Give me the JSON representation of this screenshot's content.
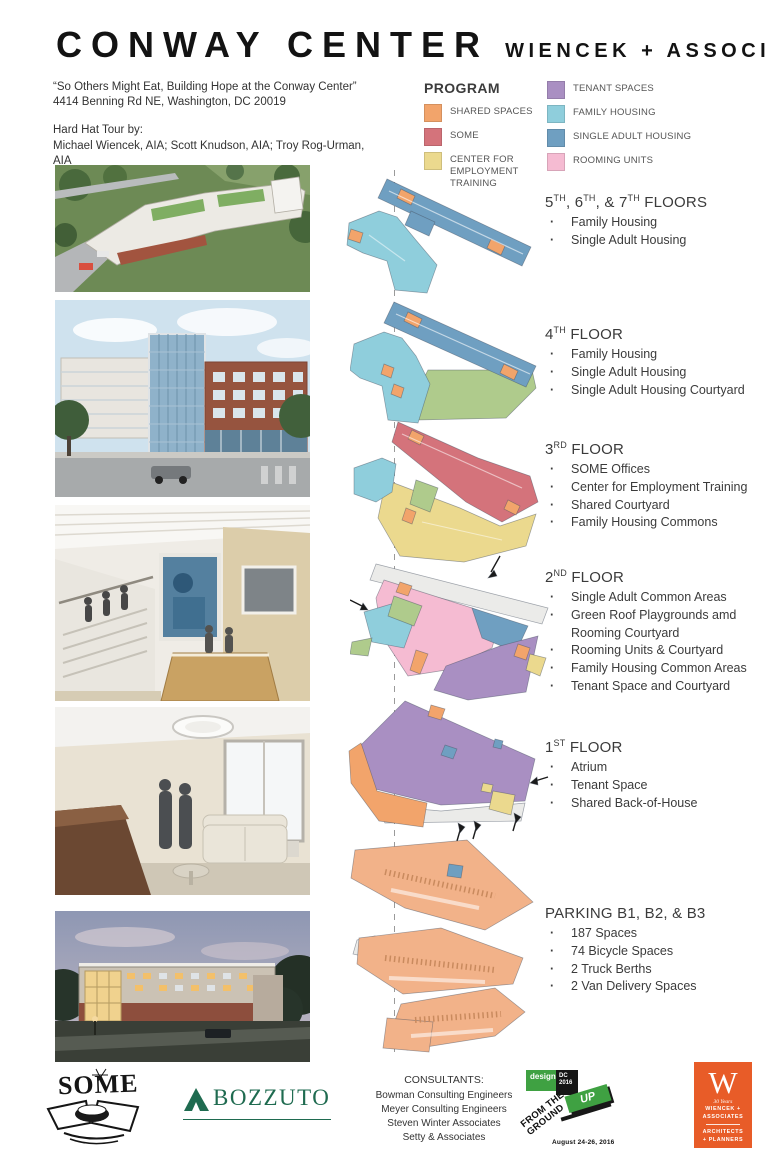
{
  "header": {
    "title": "CONWAY CENTER",
    "firm": "WIENCEK + ASSOCIATES"
  },
  "intro": {
    "quote": "“So Others Might Eat, Building Hope at the Conway Center”",
    "address": "4414 Benning Rd NE, Washington, DC 20019",
    "tour_label": "Hard Hat Tour by:",
    "tour_names": "Michael Wiencek, AIA; Scott Knudson, AIA; Troy Rog-Urman, AIA"
  },
  "colors": {
    "shared": "#F2A46B",
    "some": "#D4737B",
    "cet": "#EBD98E",
    "tenant": "#A98FC2",
    "family": "#8FCEDC",
    "single": "#6F9FC1",
    "rooming": "#F5BBD2",
    "parking": "#F2B289",
    "courtyard": "#AFCB8C",
    "grey": "#EBEBE9",
    "badge": "#E85C28",
    "bozzuto": "#1F6B50",
    "event_green": "#3FA142"
  },
  "legend": {
    "title": "PROGRAM",
    "items": [
      {
        "key": "shared",
        "label": "SHARED SPACES"
      },
      {
        "key": "some",
        "label": "SOME"
      },
      {
        "key": "cet",
        "label": "CENTER FOR EMPLOYMENT TRAINING"
      },
      {
        "key": "tenant",
        "label": "TENANT SPACES"
      },
      {
        "key": "family",
        "label": "FAMILY HOUSING"
      },
      {
        "key": "single",
        "label": "SINGLE ADULT HOUSING"
      },
      {
        "key": "rooming",
        "label": "ROOMING UNITS"
      }
    ]
  },
  "floors": [
    {
      "title_parts": [
        {
          "text": "5"
        },
        {
          "text": "TH",
          "sup": true
        },
        {
          "text": ", 6"
        },
        {
          "text": "TH",
          "sup": true
        },
        {
          "text": ", &  7"
        },
        {
          "text": "TH",
          "sup": true
        },
        {
          "text": " FLOORS"
        }
      ],
      "bullets": [
        "Family Housing",
        "Single Adult Housing"
      ]
    },
    {
      "title_parts": [
        {
          "text": "4"
        },
        {
          "text": "TH",
          "sup": true
        },
        {
          "text": " FLOOR"
        }
      ],
      "bullets": [
        "Family Housing",
        "Single Adult Housing",
        "Single Adult Housing Courtyard"
      ]
    },
    {
      "title_parts": [
        {
          "text": "3"
        },
        {
          "text": "RD",
          "sup": true
        },
        {
          "text": " FLOOR"
        }
      ],
      "bullets": [
        "SOME Offices",
        "Center for Employment Training",
        "Shared Courtyard",
        "Family Housing Commons"
      ]
    },
    {
      "title_parts": [
        {
          "text": "2"
        },
        {
          "text": "ND",
          "sup": true
        },
        {
          "text": " FLOOR"
        }
      ],
      "bullets": [
        "Single Adult Common Areas",
        "Green Roof Playgrounds amd Rooming Courtyard",
        "Rooming Units & Courtyard",
        "Family Housing Common Areas",
        "Tenant Space and Courtyard"
      ]
    },
    {
      "title_parts": [
        {
          "text": "1"
        },
        {
          "text": "ST",
          "sup": true
        },
        {
          "text": " FLOOR"
        }
      ],
      "bullets": [
        "Atrium",
        "Tenant Space",
        "Shared Back-of-House"
      ]
    },
    {
      "title_parts": [
        {
          "text": "PARKING  B1, B2, & B3"
        }
      ],
      "bullets": [
        "187 Spaces",
        "74 Bicycle Spaces",
        "2 Truck Berths",
        "2 Van Delivery Spaces"
      ]
    }
  ],
  "footer": {
    "some_logo_text": "SOME",
    "bozzuto_logo_text": "BOZZUTO",
    "consultants": {
      "title": "CONSULTANTS:",
      "names": [
        "Bowman Consulting Engineers",
        "Meyer Consulting Engineers",
        "Steven Winter Associates",
        "Setty & Associates"
      ]
    },
    "event_logo": {
      "design_text": "design",
      "dc_text": "DC 2016",
      "up_text": "UP",
      "from_line1": "FROM THE",
      "from_line2": "GROUND",
      "date": "August 24-26, 2016"
    },
    "wiencek_badge": {
      "letter": "W",
      "years": "30 Years",
      "line1": "WIENCEK +",
      "line2": "ASSOCIATES",
      "line3": "ARCHITECTS",
      "line4": "+ PLANNERS"
    }
  }
}
